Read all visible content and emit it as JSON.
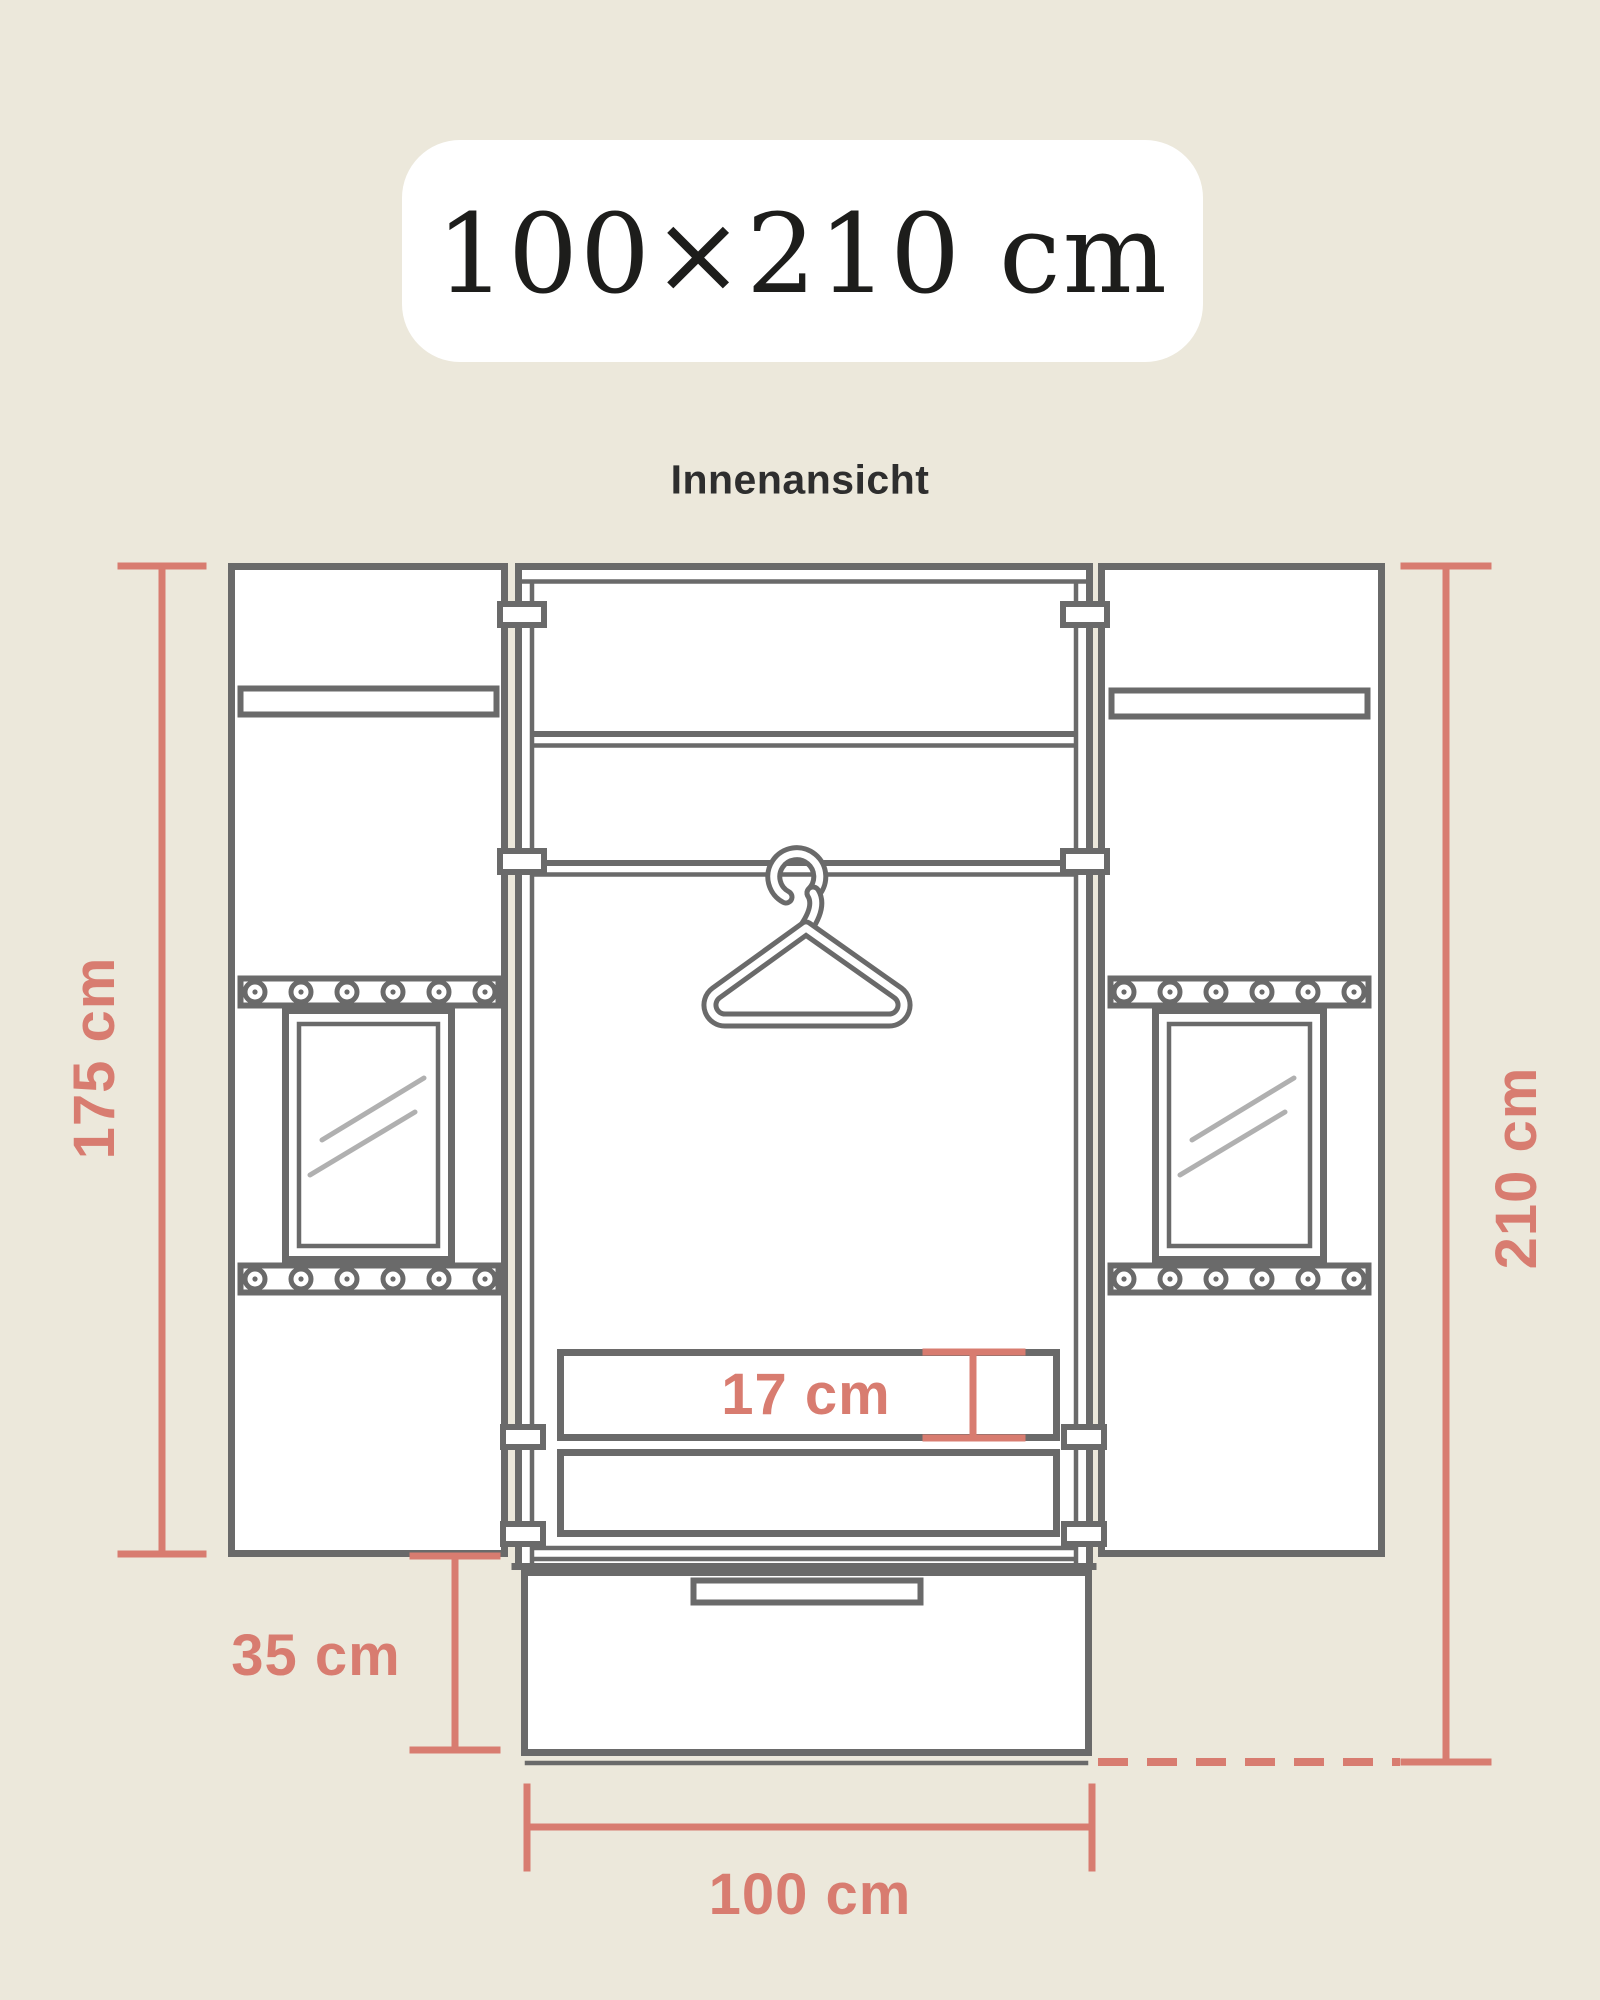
{
  "header": {
    "size_label": "100×210 cm",
    "view_label": "Innenansicht"
  },
  "dimensions": {
    "door_height": {
      "label": "175 cm",
      "value_cm": 175,
      "measures": "height of open door panels"
    },
    "total_height": {
      "label": "210 cm",
      "value_cm": 210,
      "measures": "total wardrobe height"
    },
    "base_height": {
      "label": "35 cm",
      "value_cm": 35,
      "measures": "bottom drawer section height"
    },
    "total_width": {
      "label": "100 cm",
      "value_cm": 100,
      "measures": "wardrobe width"
    },
    "shelf_clearance": {
      "label": "17 cm",
      "value_cm": 17,
      "measures": "shelf compartment height"
    }
  },
  "diagram": {
    "subject": "wardrobe interior view with open doors",
    "elements": [
      "left-door-with-window",
      "right-door-with-window",
      "top-shelf",
      "hanging-rod",
      "clothes-hanger",
      "shelf-compartments",
      "bottom-drawer"
    ],
    "rivets_per_strip": 6
  },
  "colors": {
    "background": "#ece8db",
    "badge": "#ffffff",
    "outline": "#6a6a6a",
    "glass_shine": "#b0b0b0",
    "accent": "#d87c70",
    "title_text": "#1d1d1b",
    "subtitle_text": "#2e2e2e"
  }
}
